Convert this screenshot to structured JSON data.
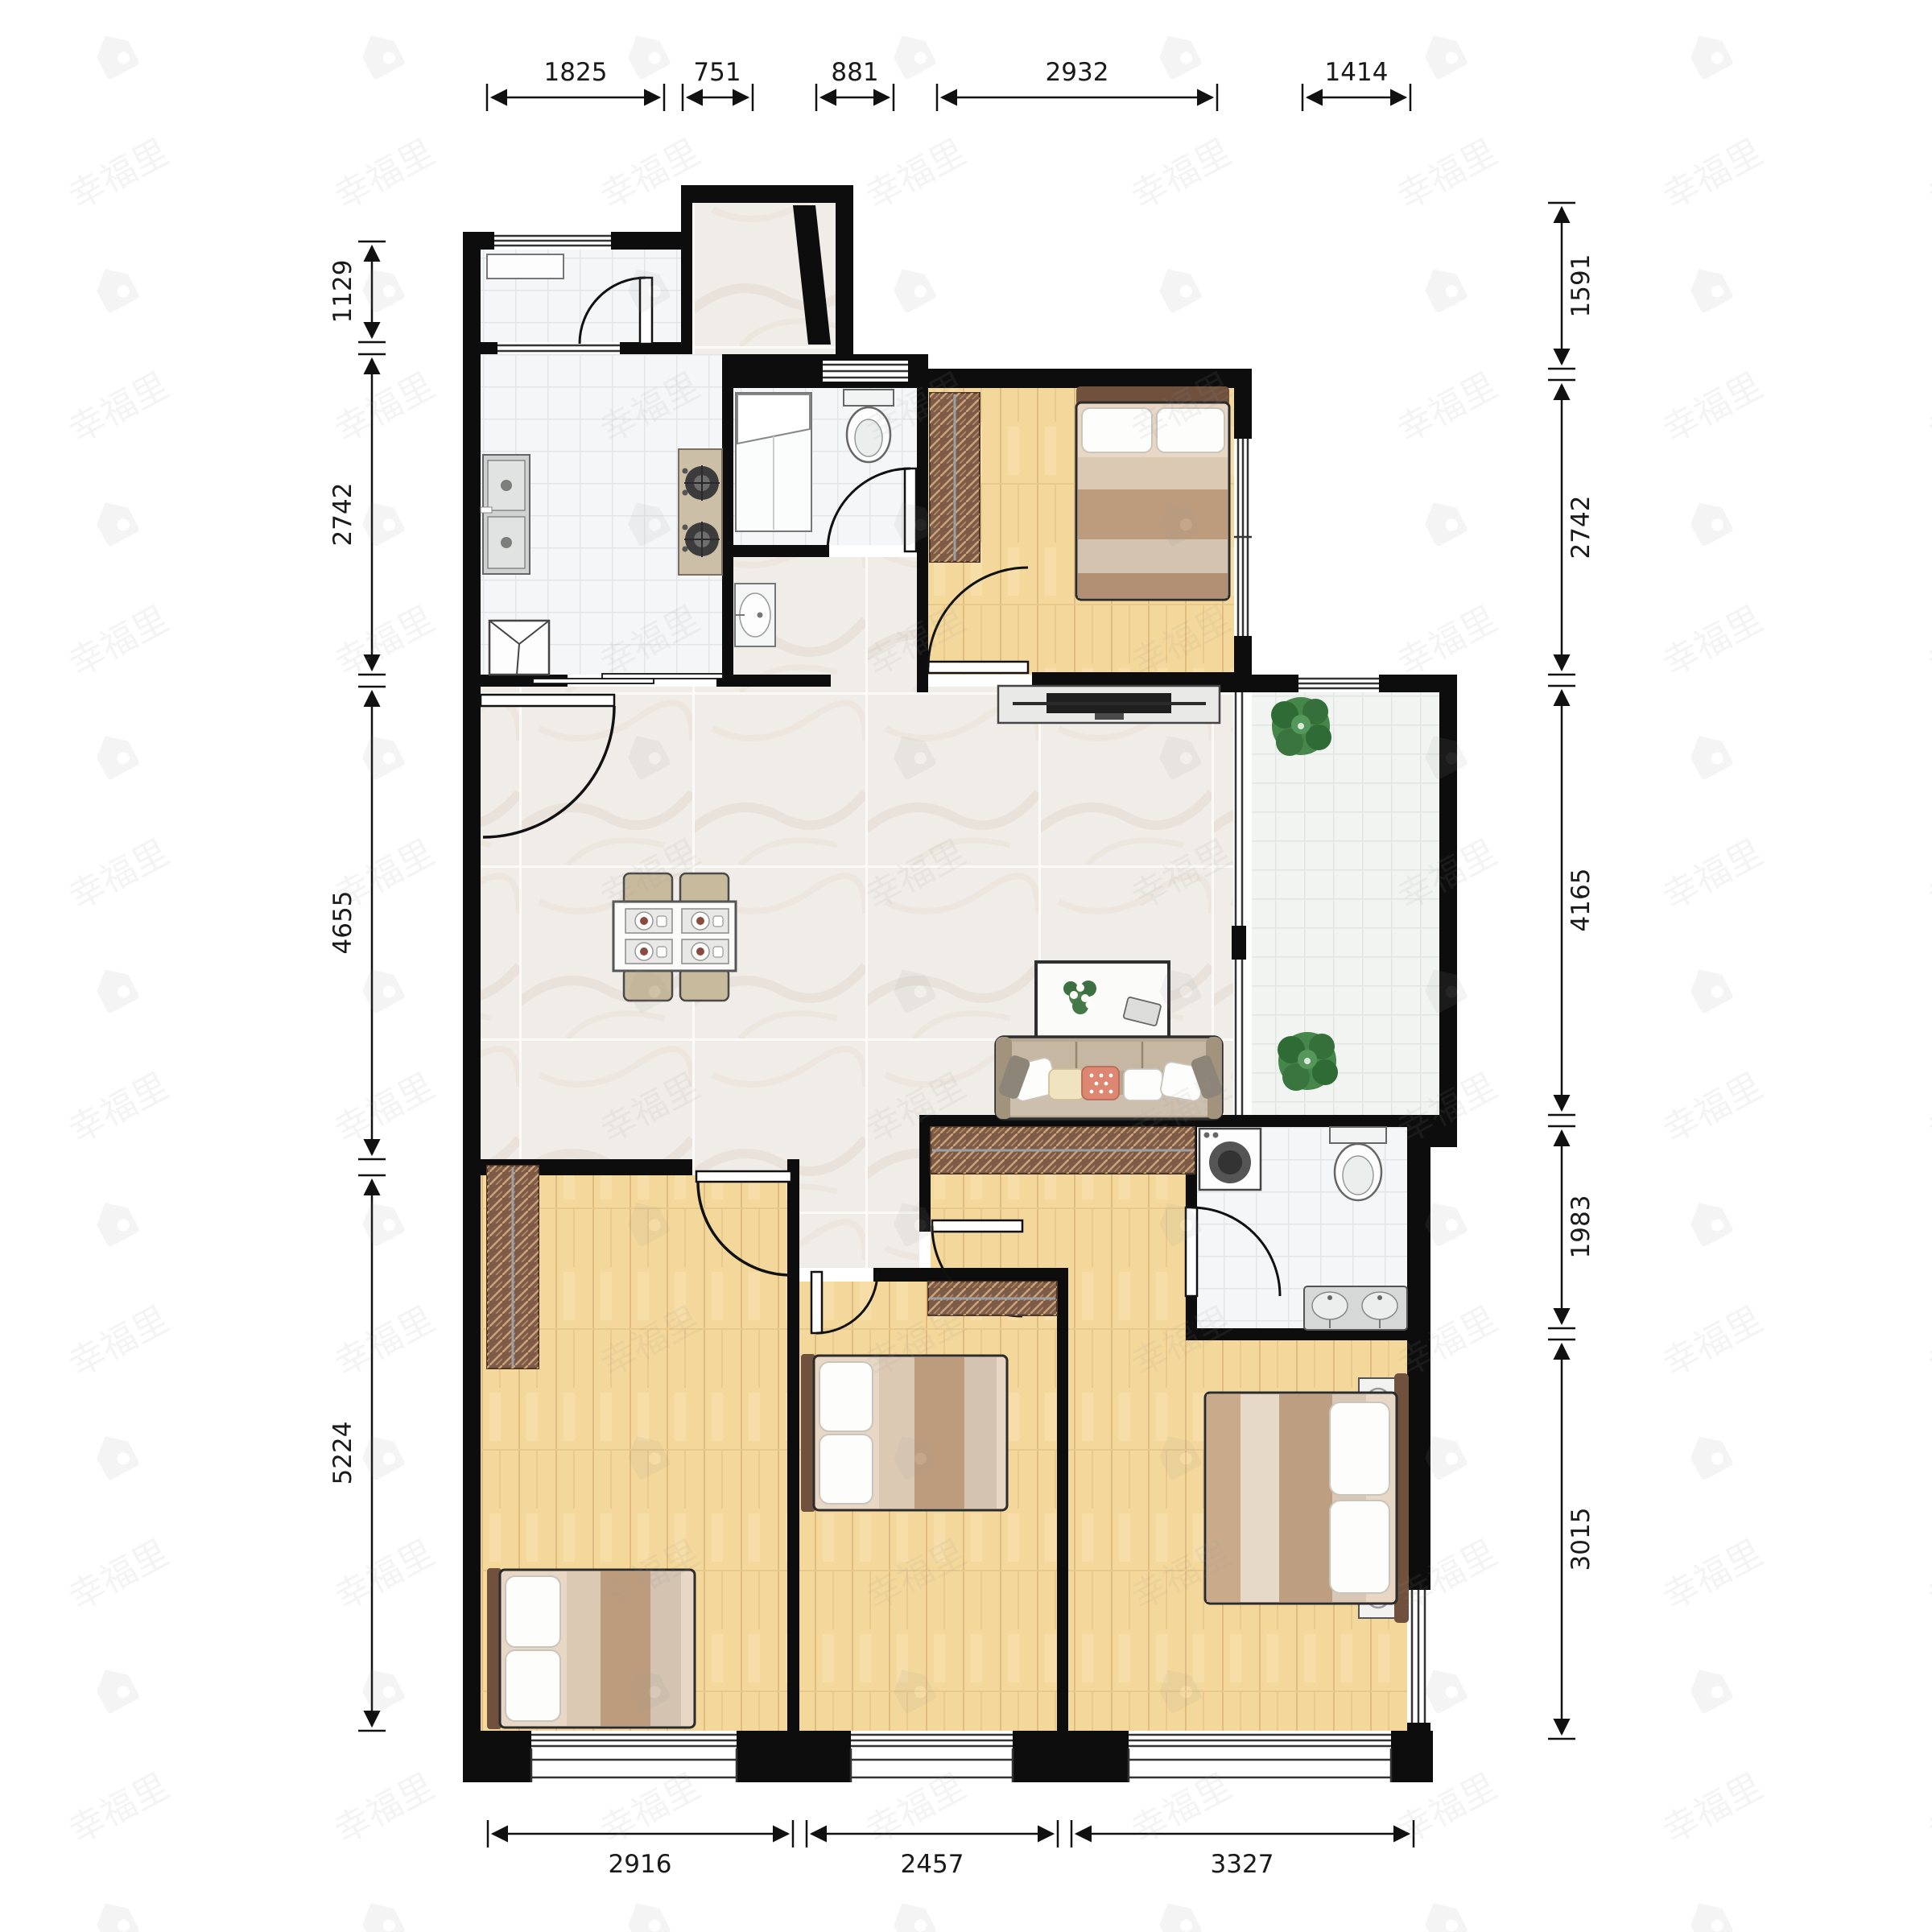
{
  "watermark": {
    "text": "幸福里"
  },
  "dimensions": {
    "top": [
      {
        "label": "1825"
      },
      {
        "label": "751"
      },
      {
        "label": "881"
      },
      {
        "label": "2932"
      },
      {
        "label": "1414"
      }
    ],
    "left": [
      {
        "label": "1129"
      },
      {
        "label": "2742"
      },
      {
        "label": "4655"
      },
      {
        "label": "5224"
      }
    ],
    "right": [
      {
        "label": "1591"
      },
      {
        "label": "2742"
      },
      {
        "label": "4165"
      },
      {
        "label": "1983"
      },
      {
        "label": "3015"
      }
    ],
    "bottom": [
      {
        "label": "2916"
      },
      {
        "label": "2457"
      },
      {
        "label": "3327"
      }
    ]
  },
  "rooms": [
    {
      "name": "utility-room",
      "floor": "white-tile",
      "furniture": [
        "shelf"
      ]
    },
    {
      "name": "entry-foyer",
      "floor": "marble",
      "furniture": [
        "entry-door-open"
      ]
    },
    {
      "name": "kitchen",
      "floor": "white-tile",
      "furniture": [
        "double-basin-sink",
        "gas-stove-2-burner",
        "refrigerator"
      ]
    },
    {
      "name": "bathroom-small",
      "floor": "white-tile",
      "furniture": [
        "shower",
        "toilet",
        "hand-basin"
      ]
    },
    {
      "name": "bedroom-top",
      "floor": "wood",
      "furniture": [
        "wardrobe",
        "double-bed"
      ]
    },
    {
      "name": "living-dining",
      "floor": "marble",
      "furniture": [
        "dining-table-4-chairs",
        "tv-console",
        "coffee-table",
        "sofa"
      ]
    },
    {
      "name": "balcony",
      "floor": "tile",
      "furniture": [
        "plant",
        "plant"
      ]
    },
    {
      "name": "bedroom-left",
      "floor": "wood",
      "furniture": [
        "wardrobe",
        "bed"
      ]
    },
    {
      "name": "bedroom-middle",
      "floor": "wood",
      "furniture": [
        "wardrobe",
        "bed"
      ]
    },
    {
      "name": "bathroom-master",
      "floor": "white-tile",
      "furniture": [
        "washing-machine",
        "toilet",
        "double-sink-vanity"
      ]
    },
    {
      "name": "bedroom-master",
      "floor": "wood",
      "furniture": [
        "wardrobe-long",
        "double-bed",
        "nightstand",
        "nightstand"
      ]
    }
  ],
  "colors": {
    "wall": "#0d0d0d",
    "wood_floor": "#f4d89b",
    "marble_floor": "#f0ece7",
    "white_tile": "#f5f6f7",
    "balcony_tile": "#f2f4f2",
    "wardrobe": "#7d5b47",
    "sofa": "#bfae9a",
    "plant": "#3f7d44",
    "dimension_text": "#1a1a1a",
    "watermark": "#8a8a8a"
  }
}
